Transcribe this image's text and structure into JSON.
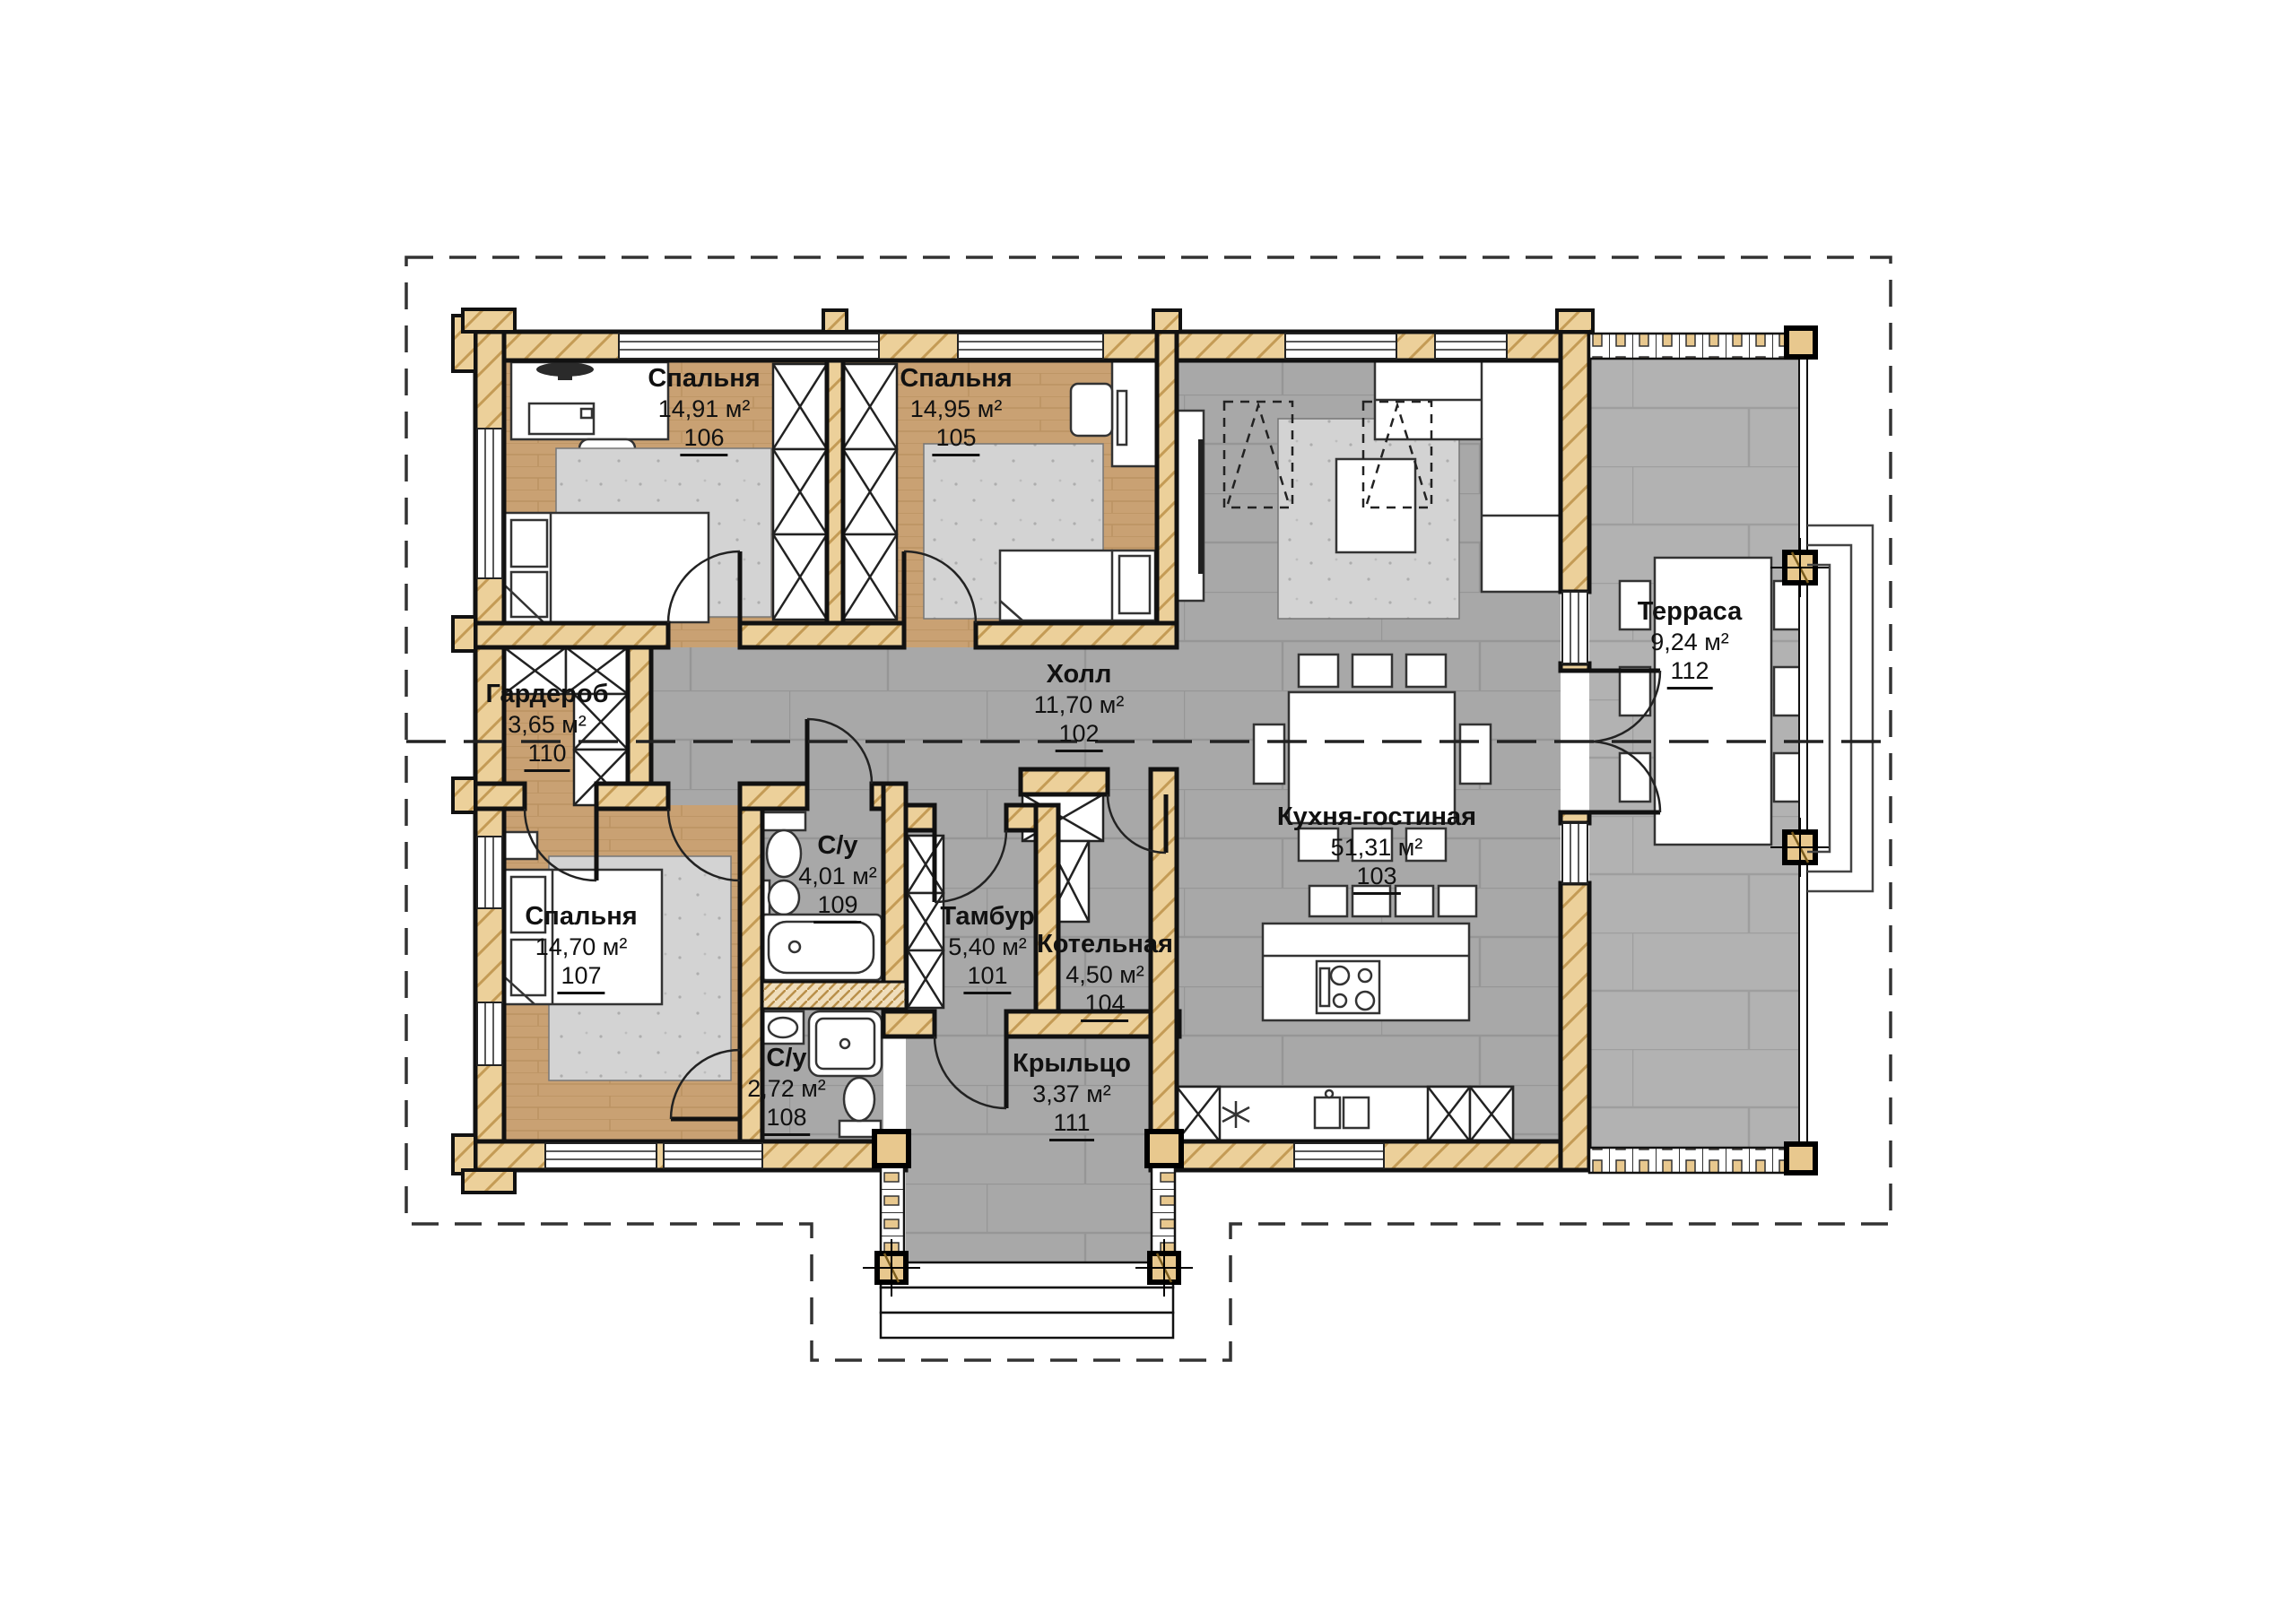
{
  "rooms": [
    {
      "name": "Тамбур",
      "area": "5,40 м²",
      "number": "101"
    },
    {
      "name": "Холл",
      "area": "11,70 м²",
      "number": "102"
    },
    {
      "name": "Кухня-гостиная",
      "area": "51,31 м²",
      "number": "103"
    },
    {
      "name": "Котельная",
      "area": "4,50 м²",
      "number": "104"
    },
    {
      "name": "Спальня",
      "area": "14,95 м²",
      "number": "105"
    },
    {
      "name": "Спальня",
      "area": "14,91 м²",
      "number": "106"
    },
    {
      "name": "Спальня",
      "area": "14,70 м²",
      "number": "107"
    },
    {
      "name": "С/у",
      "area": "2,72 м²",
      "number": "108"
    },
    {
      "name": "С/у",
      "area": "4,01 м²",
      "number": "109"
    },
    {
      "name": "Гардероб",
      "area": "3,65 м²",
      "number": "110"
    },
    {
      "name": "Крыльцо",
      "area": "3,37 м²",
      "number": "111"
    },
    {
      "name": "Терраса",
      "area": "9,24 м²",
      "number": "112"
    }
  ],
  "colors": {
    "wall_wood": "#ecd09a",
    "wall_hatch": "#c49b55",
    "floor_wood": "#c9a173",
    "floor_tile": "#a8a8a8",
    "floor_terrace": "#b2b2b2",
    "line": "#111111",
    "rug": "#d3d3d3"
  }
}
